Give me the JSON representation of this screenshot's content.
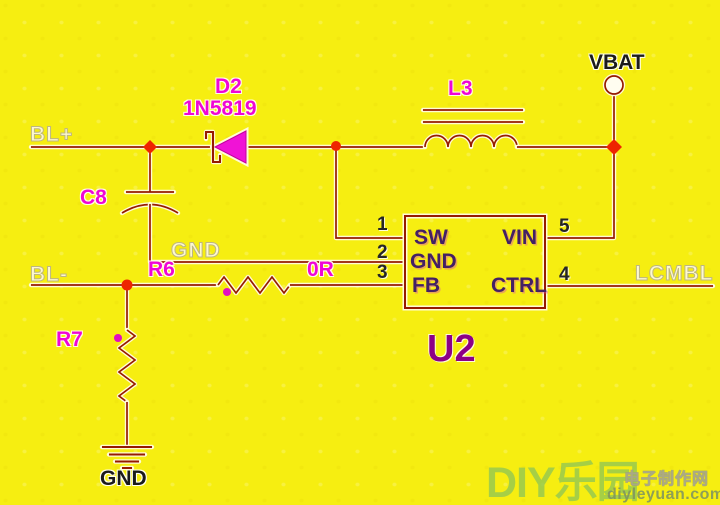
{
  "nets": {
    "bl_plus": "BL+",
    "bl_minus": "BL-",
    "gnd_wire": "GND",
    "lcmbl": "LCMBL"
  },
  "power": {
    "vbat": "VBAT",
    "gnd": "GND"
  },
  "components": {
    "d2": {
      "ref": "D2",
      "value": "1N5819"
    },
    "l3": {
      "ref": "L3"
    },
    "c8": {
      "ref": "C8"
    },
    "r6": {
      "ref": "R6",
      "value": "0R"
    },
    "r7": {
      "ref": "R7"
    },
    "u2": {
      "ref": "U2",
      "pins": [
        {
          "num": "1",
          "name": "SW"
        },
        {
          "num": "2",
          "name": "GND"
        },
        {
          "num": "3",
          "name": "FB"
        },
        {
          "num": "5",
          "name": "VIN"
        },
        {
          "num": "4",
          "name": "CTRL"
        }
      ]
    }
  },
  "watermark": {
    "logo": "DIY乐园",
    "site": "电子制作网",
    "url": "diyleyuan.com"
  },
  "colors": {
    "background": "#f6ee11",
    "wire": "#961a00",
    "junction": "#ee2500",
    "component_label": "#ef06d6",
    "diode_fill": "#f013d6",
    "ic_text": "#432064",
    "watermark_green": "#9cc75e"
  }
}
